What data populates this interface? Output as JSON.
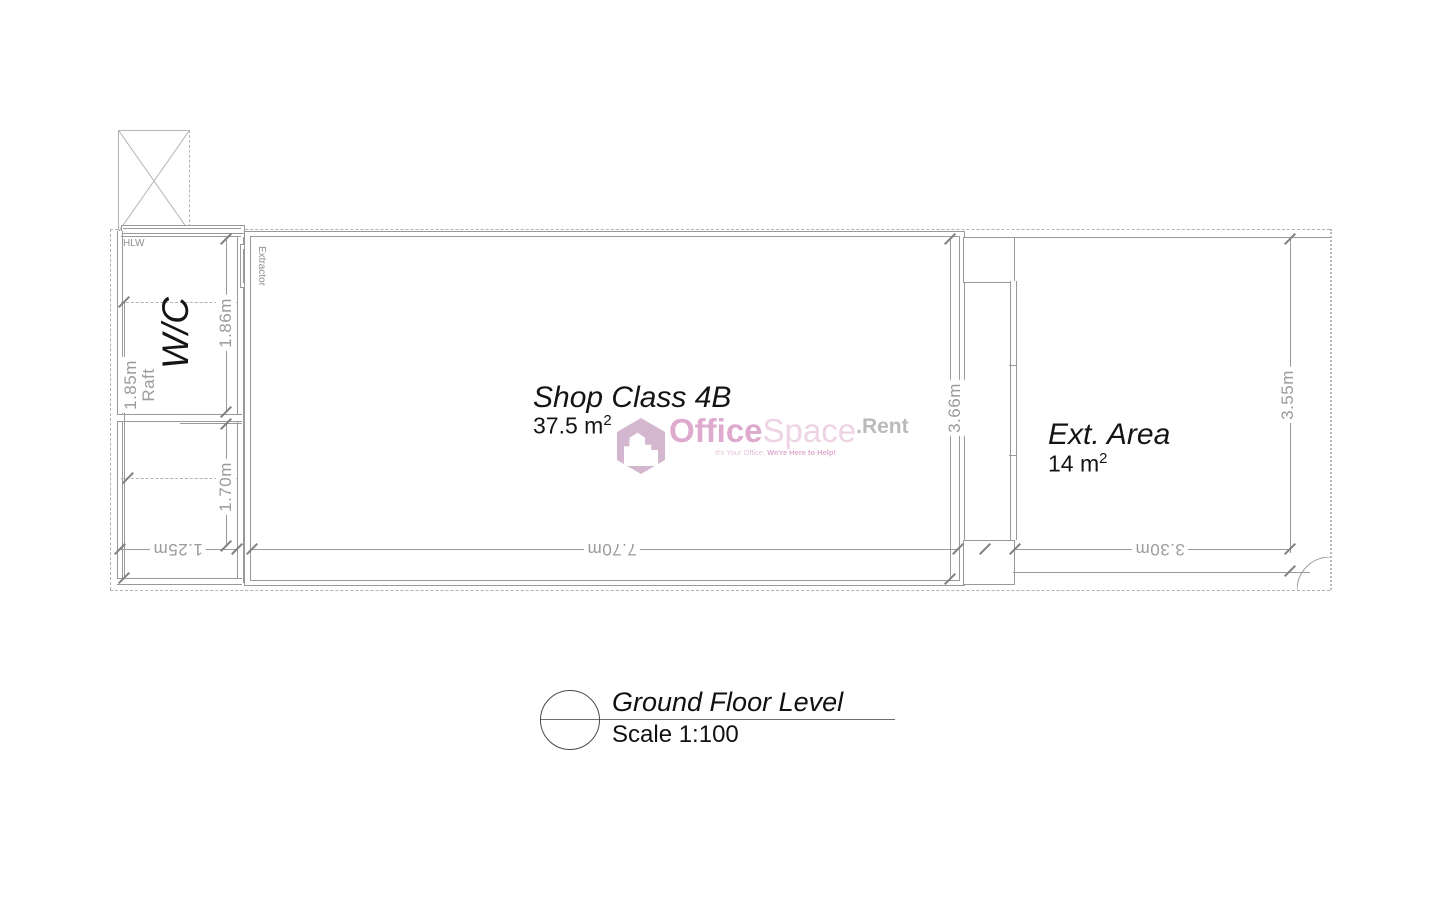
{
  "plan": {
    "wc_label": "W/C",
    "shop_name": "Shop Class 4B",
    "shop_area": "37.5 m",
    "ext_name": "Ext. Area",
    "ext_area": "14 m",
    "sup": "2",
    "hlw": "HLW",
    "extractor": "Extractor",
    "dims": {
      "d185": "1.85m",
      "raft": "Raft",
      "d186": "1.86m",
      "d170": "1.70m",
      "d125": "1.25m",
      "d770": "7.70m",
      "d366": "3.66m",
      "d330": "3.30m",
      "d355": "3.55m"
    }
  },
  "title_block": {
    "title": "Ground Floor Level",
    "scale": "Scale 1:100"
  },
  "watermark": {
    "office": "Office",
    "space": "Space",
    "rent": ".Rent",
    "tagline_1": "It's Your Office, ",
    "tagline_2": "We're Here to Help!",
    "colors": {
      "office": "#d795c1",
      "space": "#e9c9dd",
      "rent": "#a9a9a9",
      "hexagon": "#c9a6c4"
    }
  }
}
